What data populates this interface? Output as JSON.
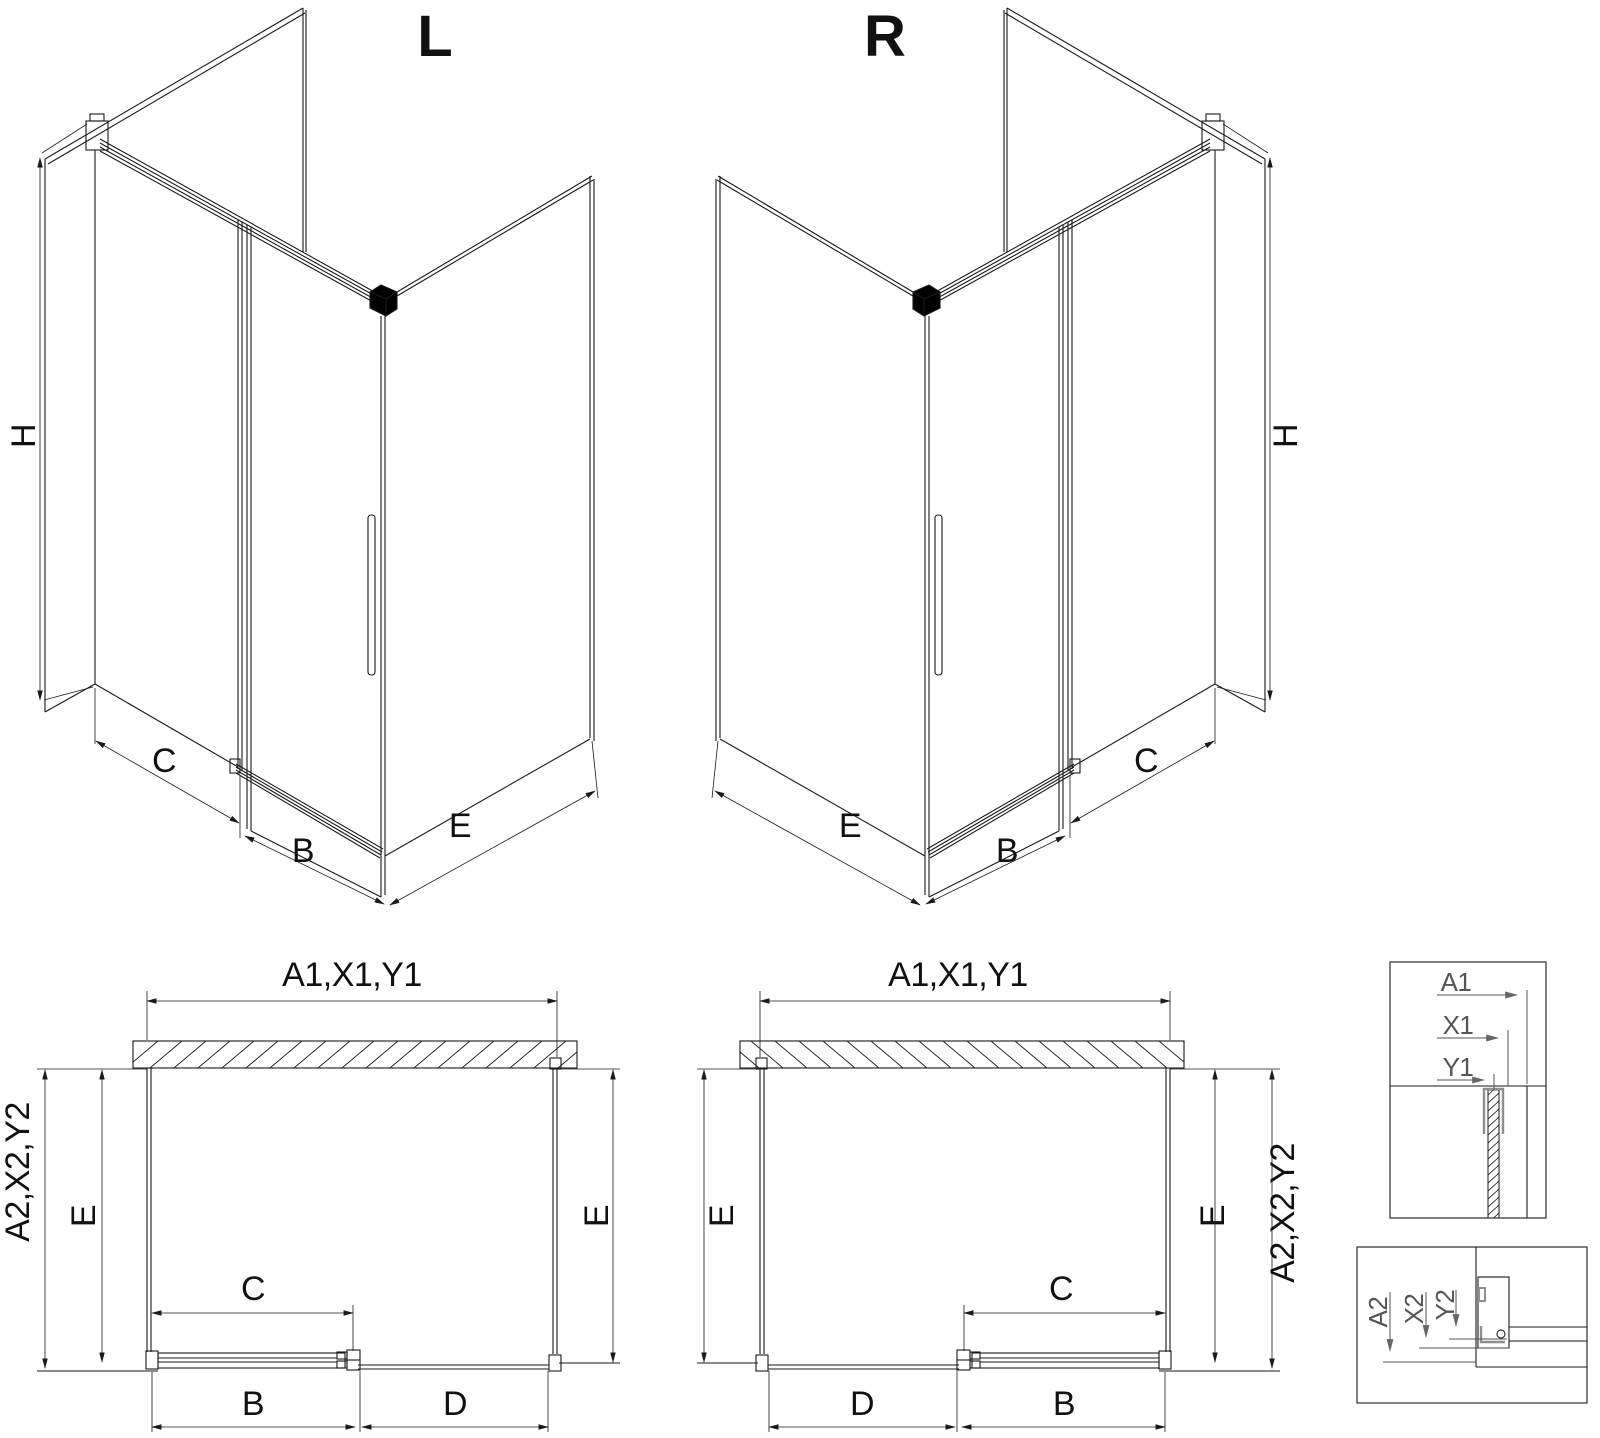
{
  "drawing": {
    "iso_left": {
      "title": "L",
      "height_label": "H",
      "bottom_labels": [
        "C",
        "B",
        "E"
      ]
    },
    "iso_right": {
      "title": "R",
      "height_label": "H",
      "bottom_labels": [
        "E",
        "B",
        "C"
      ]
    },
    "plan_left": {
      "top_width_label": "A1,X1,Y1",
      "side_depth_label": "A2,X2,Y2",
      "left_inner_label": "E",
      "right_inner_label": "E",
      "door_width_label": "C",
      "bottom_left_label": "B",
      "bottom_right_label": "D"
    },
    "plan_right": {
      "top_width_label": "A1,X1,Y1",
      "side_depth_label": "A2,X2,Y2",
      "left_inner_label": "E",
      "right_inner_label": "E",
      "door_width_label": "C",
      "bottom_left_label": "D",
      "bottom_right_label": "B"
    },
    "detail_wall_profile": {
      "labels": [
        "A1",
        "X1",
        "Y1"
      ]
    },
    "detail_floor_profile": {
      "labels": [
        "A2",
        "X2",
        "Y2"
      ]
    },
    "colors": {
      "line": "#1a1a1a",
      "dimension": "#1f1f1f",
      "detail_gray": "#8f8f8f",
      "detail_text": "#555555",
      "background": "#ffffff"
    }
  }
}
